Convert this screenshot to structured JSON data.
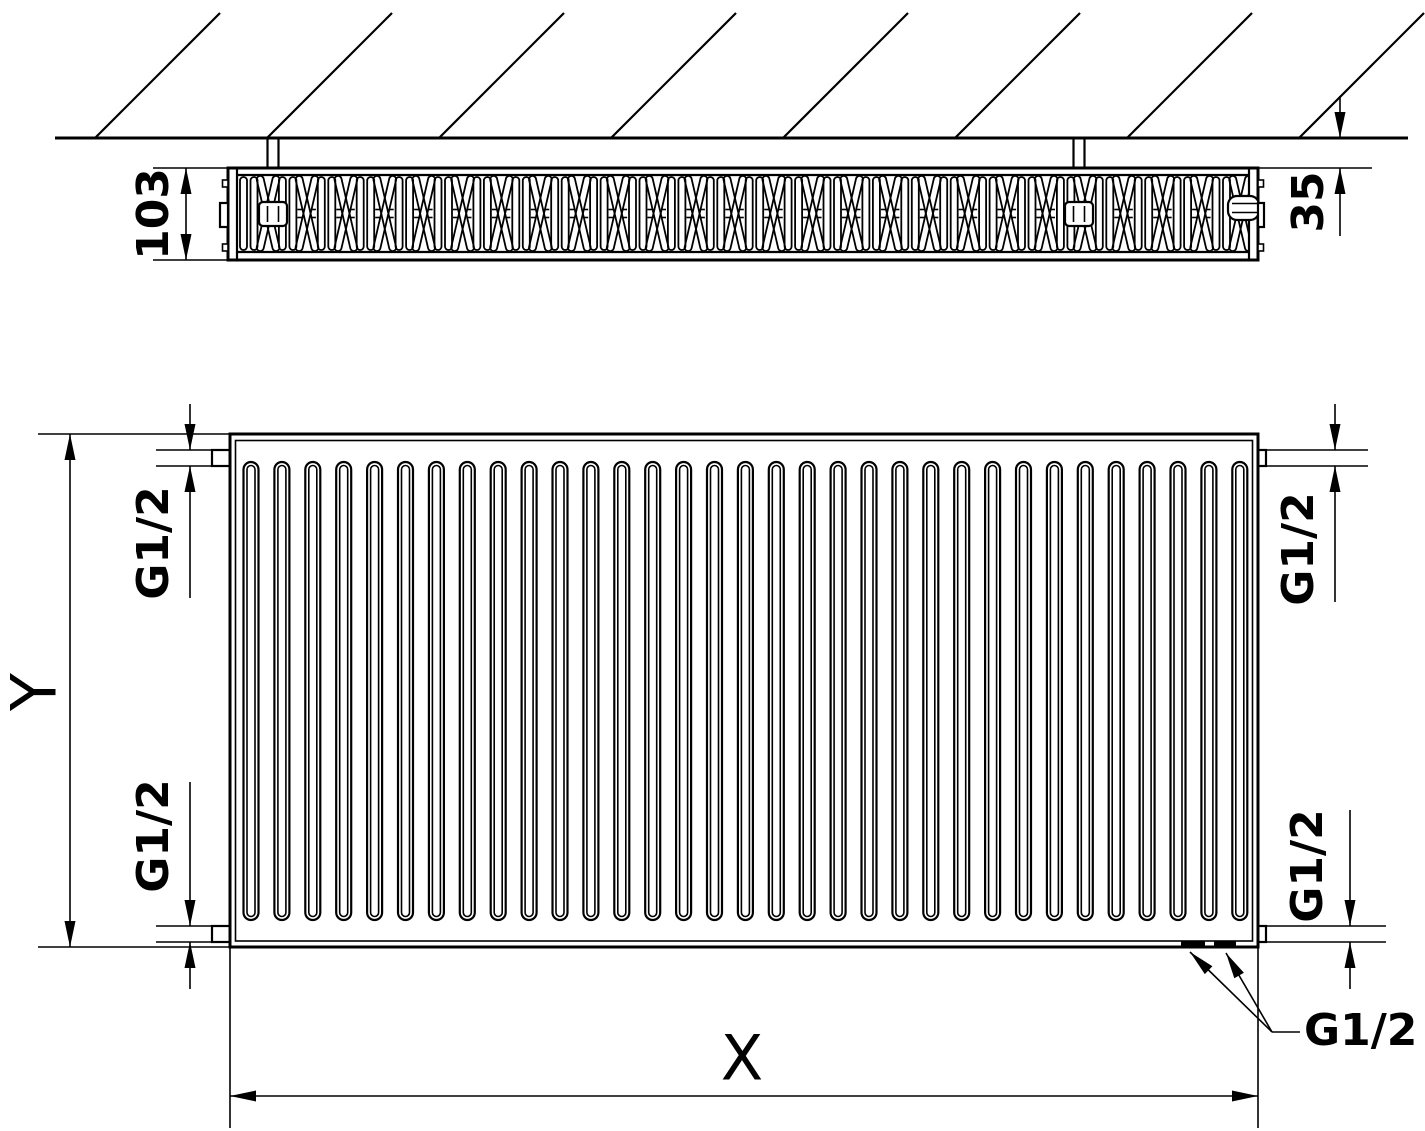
{
  "drawing": {
    "kind": "radiator-technical-drawing",
    "views": [
      "top-section-view",
      "front-view"
    ]
  },
  "labels": {
    "depth": "103",
    "wall_gap": "35",
    "height": "Y",
    "width": "X",
    "thread_top_left": "G1/2",
    "thread_top_right": "G1/2",
    "thread_bottom_left": "G1/2",
    "thread_bottom_right": "G1/2",
    "thread_bottom_center": "G1/2"
  },
  "colors": {
    "line": "#000000",
    "background": "#ffffff"
  }
}
